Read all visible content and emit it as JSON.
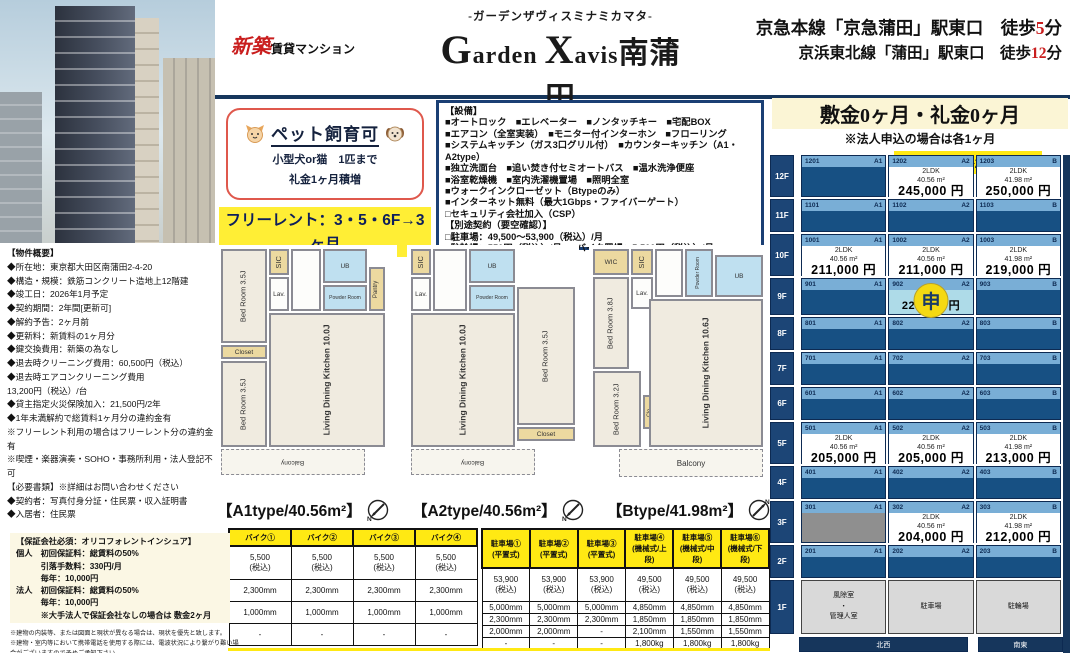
{
  "header": {
    "badge_new": "新築",
    "badge_rest": "賃貸マンション",
    "kana": "-ガーデンザヴィスミナミカマタ-",
    "title_parts": {
      "g": "G",
      "arden": "arden ",
      "x": "X",
      "avis": "avis",
      "jp": "南蒲田"
    }
  },
  "stations": [
    {
      "name": "京急本線「京急蒲田」駅東口　",
      "prefix": "徒歩",
      "minutes": "5",
      "unit": "分"
    },
    {
      "name": "京浜東北線「蒲田」駅東口　",
      "prefix": "徒歩",
      "minutes": "12",
      "unit": "分"
    }
  ],
  "pet": {
    "title": "ペット飼育可",
    "line1": "小型犬or猫　1匹まで",
    "line2": "礼金1ヶ月積増"
  },
  "free_rent": {
    "line1": "フリーレント：3・5・6F→3ヶ月",
    "line2": "9・10・12F→2ヶ月"
  },
  "equipment": {
    "lines": [
      "【設備】",
      "■オートロック　■エレベーター　■ノンタッチキー　■宅配BOX",
      "■エアコン（全室実装）　■モニター付インターホン　■フローリング",
      "■システムキッチン（ガス3口グリル付）　■カウンターキッチン（A1・A2type）",
      "■独立洗面台　■追い焚き付セミオートバス　■温水洗浄便座",
      "■浴室乾燥機　■室内洗濯機置場　■照明全室",
      "■ウォークインクローゼット（Btypeのみ）",
      "■インターネット無料（最大1Gbps・ファイバーゲート）",
      "□セキュリティ会社加入（CSP）",
      "【別途契約（要空確認）】",
      "□駐車場：49,500～53,900（税込）/月",
      "□駐輪場：550円（税込）/月　□バイク置場：5,500円（税込）/月"
    ]
  },
  "deposit": {
    "main": "敷金0ヶ月・礼金0ヶ月",
    "note": "※法人申込の場合は各1ヶ月",
    "fee": "共益費：各20,000円"
  },
  "overview": {
    "lines": [
      "【物件概要】",
      "◆所在地：東京都大田区南蒲田2-4-20",
      "◆構造・規模：鉄筋コンクリート造地上12階建",
      "◆竣工日：2026年1月予定",
      "◆契約期間：2年間[更新可]",
      "◆解約予告：2ヶ月前",
      "◆更新料：新賃料の1ヶ月分",
      "◆鍵交換費用：新築の為なし",
      "◆退去時クリーニング費用：60,500円（税込）",
      "◆退去時エアコンクリーニング費用",
      "13,200円（税込）/台",
      "◆貸主指定火災保険加入：21,500円/2年",
      "◆1年未満解約で総賃料1ヶ月分の違約金有",
      "※フリーレント利用の場合はフリーレント分の違約金有",
      "※喫煙・楽器演奏・SOHO・事務所利用・法人登記不可",
      "【必要書類】※詳細はお問い合わせください",
      "◆契約者：写真付身分証・住民票・収入証明書",
      "◆入居者：住民票"
    ]
  },
  "guarantor": {
    "lines": [
      "【保証会社必須：オリコフォレントインシュア】",
      "個人　初回保証料：総賃料の50%",
      "　　　引落手数料：330円/月",
      "　　　毎年：10,000円",
      "法人　初回保証料：総賃料の50%",
      "　　　毎年：10,000円",
      "　　　※大手法人で保証会社なしの場合は 敷金2ヶ月"
    ]
  },
  "fine_print": {
    "lines": [
      "※建物の内装等、または図面と現状が異なる場合は、現状を優先と致します。",
      "※建物・室内等において携帯電話を使用する際には、電波状況により繋がり難い場合がございますので予めご承知下さい。"
    ]
  },
  "floorplans": {
    "a1": {
      "bed1": "Bed Room 3.5J",
      "closet1": "Closet",
      "bed2": "Bed Room 3.5J",
      "sic": "SIC",
      "lav": "Lav.",
      "ub": "UB",
      "powder": "Powder Room",
      "pantry": "Pantry",
      "ldk": "Living Dining Kitchen 10.0J",
      "balcony": "Balcony"
    },
    "a2": {
      "sic": "SIC",
      "lav": "Lav.",
      "ub": "UB",
      "powder": "Powder Room",
      "ldk": "Living Dining Kitchen 10.0J",
      "bed1": "Bed Room 3.5J",
      "closet1": "Closet",
      "balcony": "Balcony"
    },
    "b": {
      "wic": "WIC",
      "sic": "SIC",
      "lav": "Lav.",
      "powder": "Powder Room",
      "ub": "UB",
      "bed1": "Bed Room 3.8J",
      "bed2": "Bed Room 3.2J",
      "clo": "Clo.",
      "ldk": "Living Dining Kitchen 10.6J",
      "balcony": "Balcony"
    }
  },
  "plan_labels": [
    "【A1type/40.56m²】",
    "【A2type/40.56m²】",
    "【Btype/41.98m²】"
  ],
  "bike_table": {
    "headers": [
      "バイク①",
      "バイク②",
      "バイク③",
      "バイク④"
    ],
    "rows": [
      [
        "5,500\n(税込)",
        "5,500\n(税込)",
        "5,500\n(税込)",
        "5,500\n(税込)"
      ],
      [
        "2,300mm",
        "2,300mm",
        "2,300mm",
        "2,300mm"
      ],
      [
        "1,000mm",
        "1,000mm",
        "1,000mm",
        "1,000mm"
      ],
      [
        "-",
        "-",
        "-",
        "-"
      ]
    ]
  },
  "parking_table": {
    "headers": [
      "駐車場①\n(平置式)",
      "駐車場②\n(平置式)",
      "駐車場③\n(平置式)",
      "駐車場④\n(機械式/上段)",
      "駐車場⑤\n(機械式/中段)",
      "駐車場⑥\n(機械式/下段)"
    ],
    "rows": [
      [
        "53,900\n(税込)",
        "53,900\n(税込)",
        "53,900\n(税込)",
        "49,500\n(税込)",
        "49,500\n(税込)",
        "49,500\n(税込)"
      ],
      [
        "5,000mm",
        "5,000mm",
        "5,000mm",
        "4,850mm",
        "4,850mm",
        "4,850mm"
      ],
      [
        "2,300mm",
        "2,300mm",
        "2,300mm",
        "1,850mm",
        "1,850mm",
        "1,850mm"
      ],
      [
        "2,000mm",
        "2,000mm",
        "-",
        "2,100mm",
        "1,550mm",
        "1,550mm"
      ],
      [
        "-",
        "-",
        "-",
        "1,800kg",
        "1,800kg",
        "1,800kg"
      ]
    ]
  },
  "price_grid": {
    "floors": [
      {
        "label": "12F",
        "cells": [
          {
            "room": "1201",
            "type": "A1",
            "state": "taken"
          },
          {
            "room": "1202",
            "type": "A2",
            "state": "open",
            "layout": "2LDK",
            "area": "40.56 m²",
            "price": "245,000 円"
          },
          {
            "room": "1203",
            "type": "B",
            "state": "open",
            "layout": "2LDK",
            "area": "41.98 m²",
            "price": "250,000 円"
          }
        ]
      },
      {
        "label": "11F",
        "cells": [
          {
            "room": "1101",
            "type": "A1",
            "state": "taken"
          },
          {
            "room": "1102",
            "type": "A2",
            "state": "taken"
          },
          {
            "room": "1103",
            "type": "B",
            "state": "taken"
          }
        ]
      },
      {
        "label": "10F",
        "cells": [
          {
            "room": "1001",
            "type": "A1",
            "state": "open",
            "layout": "2LDK",
            "area": "40.56 m²",
            "price": "211,000 円"
          },
          {
            "room": "1002",
            "type": "A2",
            "state": "open",
            "layout": "2LDK",
            "area": "40.56 m²",
            "price": "211,000 円"
          },
          {
            "room": "1003",
            "type": "B",
            "state": "open",
            "layout": "2LDK",
            "area": "41.98 m²",
            "price": "219,000 円"
          }
        ]
      },
      {
        "label": "9F",
        "cells": [
          {
            "room": "901",
            "type": "A1",
            "state": "taken"
          },
          {
            "room": "902",
            "type": "A2",
            "state": "applied",
            "badge": "申",
            "price": "220,000 円"
          },
          {
            "room": "903",
            "type": "B",
            "state": "taken"
          }
        ]
      },
      {
        "label": "8F",
        "cells": [
          {
            "room": "801",
            "type": "A1",
            "state": "taken"
          },
          {
            "room": "802",
            "type": "A2",
            "state": "taken"
          },
          {
            "room": "803",
            "type": "B",
            "state": "taken"
          }
        ]
      },
      {
        "label": "7F",
        "cells": [
          {
            "room": "701",
            "type": "A1",
            "state": "taken"
          },
          {
            "room": "702",
            "type": "A2",
            "state": "taken"
          },
          {
            "room": "703",
            "type": "B",
            "state": "taken"
          }
        ]
      },
      {
        "label": "6F",
        "cells": [
          {
            "room": "601",
            "type": "A1",
            "state": "taken"
          },
          {
            "room": "602",
            "type": "A2",
            "state": "taken"
          },
          {
            "room": "603",
            "type": "B",
            "state": "taken"
          }
        ]
      },
      {
        "label": "5F",
        "cells": [
          {
            "room": "501",
            "type": "A1",
            "state": "open",
            "layout": "2LDK",
            "area": "40.56 m²",
            "price": "205,000 円"
          },
          {
            "room": "502",
            "type": "A2",
            "state": "open",
            "layout": "2LDK",
            "area": "40.56 m²",
            "price": "205,000 円"
          },
          {
            "room": "503",
            "type": "B",
            "state": "open",
            "layout": "2LDK",
            "area": "41.98 m²",
            "price": "213,000 円"
          }
        ]
      },
      {
        "label": "4F",
        "cells": [
          {
            "room": "401",
            "type": "A1",
            "state": "taken"
          },
          {
            "room": "402",
            "type": "A2",
            "state": "taken"
          },
          {
            "room": "403",
            "type": "B",
            "state": "taken"
          }
        ]
      },
      {
        "label": "3F",
        "cells": [
          {
            "room": "301",
            "type": "A1",
            "state": "gray"
          },
          {
            "room": "302",
            "type": "A2",
            "state": "open",
            "layout": "2LDK",
            "area": "40.56 m²",
            "price": "204,000 円"
          },
          {
            "room": "303",
            "type": "B",
            "state": "open",
            "layout": "2LDK",
            "area": "41.98 m²",
            "price": "212,000 円"
          }
        ]
      },
      {
        "label": "2F",
        "cells": [
          {
            "room": "201",
            "type": "A1",
            "state": "taken"
          },
          {
            "room": "202",
            "type": "A2",
            "state": "taken"
          },
          {
            "room": "203",
            "type": "B",
            "state": "taken"
          }
        ]
      },
      {
        "label": "1F",
        "cells": [
          {
            "state": "facility",
            "text": "風除室\n・\n管理人室"
          },
          {
            "state": "facility",
            "text": "駐車場"
          },
          {
            "state": "facility",
            "text": "駐輪場"
          }
        ]
      }
    ],
    "footer": [
      {
        "text": "北西"
      },
      {
        "text": "南東"
      }
    ]
  },
  "colors": {
    "navy": "#16365c",
    "red": "#c91e1e",
    "yellow": "#ffe913",
    "cell_taken": "#175083",
    "cell_header_strip": "#79aed6",
    "applied_bg": "#aedbe8",
    "badge_yellow": "#f4d912"
  }
}
